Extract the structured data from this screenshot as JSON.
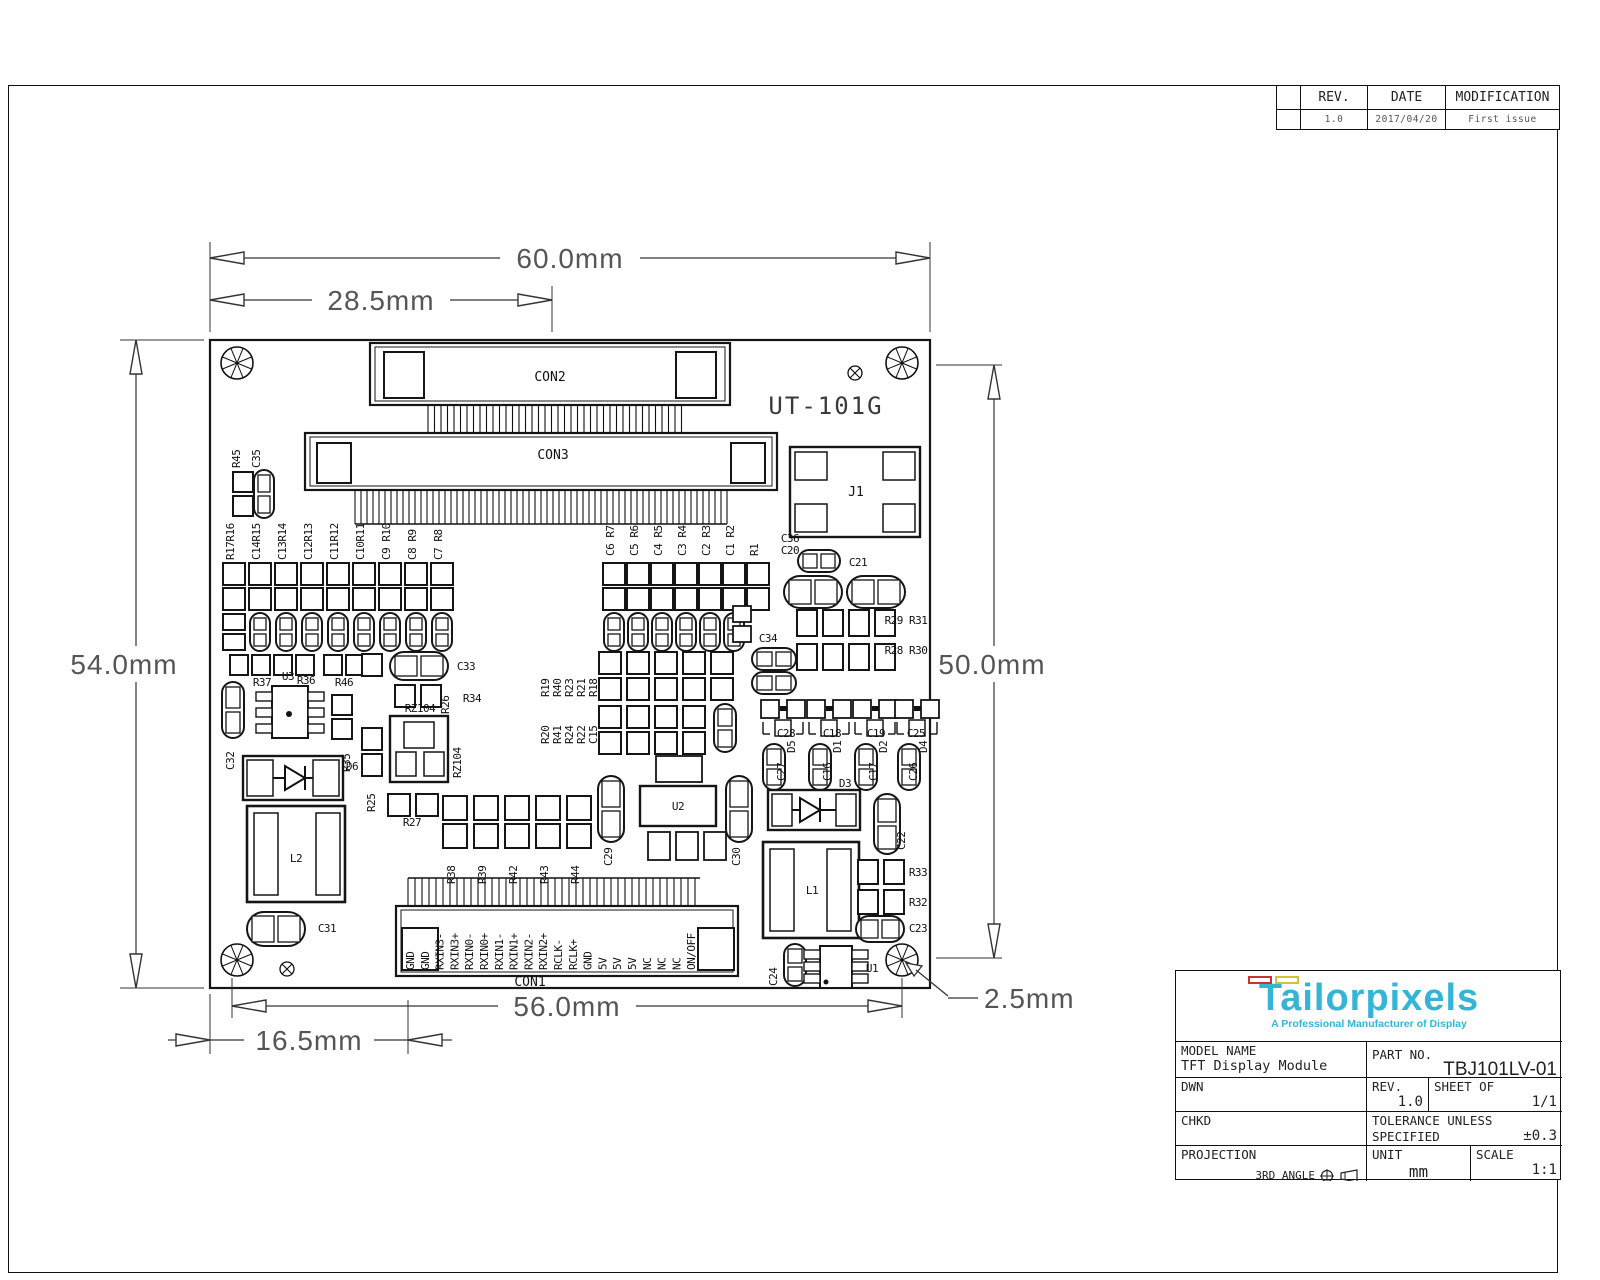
{
  "revision_table": {
    "headers": [
      "REV.",
      "DATE",
      "MODIFICATION"
    ],
    "row": {
      "rev": "1.0",
      "date": "2017/04/20",
      "modification": "First issue"
    }
  },
  "title_block": {
    "logo_text": "Tailorpixels",
    "logo_tagline": "A Professional Manufacturer of Display",
    "colors": {
      "accent_cyan": "#35b5d6",
      "flag_red": "#cc3333",
      "flag_yellow": "#cfc23a"
    },
    "fields": {
      "model_name_label": "MODEL NAME",
      "model_name": "TFT Display Module",
      "part_no_label": "PART NO.",
      "part_no": "TBJ101LV-01",
      "dwn_label": "DWN",
      "rev_label": "REV.",
      "rev": "1.0",
      "sheet_label": "SHEET OF",
      "sheet": "1/1",
      "chkd_label": "CHKD",
      "tolerance_label_line1": "TOLERANCE UNLESS",
      "tolerance_label_line2": "SPECIFIED",
      "tolerance": "±0.3",
      "projection_label": "PROJECTION",
      "projection": "3RD ANGLE",
      "unit_label": "UNIT",
      "unit": "mm",
      "scale_label": "SCALE",
      "scale": "1:1"
    }
  },
  "drawing": {
    "board_title": "UT-101G",
    "dimensions": {
      "width_overall": "60.0mm",
      "width_con2": "28.5mm",
      "height_left": "54.0mm",
      "height_right": "50.0mm",
      "width_bottom": "56.0mm",
      "offset_con1": "16.5mm",
      "hole_inset": "2.5mm"
    },
    "connector_labels": {
      "con1": "CON1",
      "con2": "CON2",
      "con3": "CON3",
      "j1": "J1"
    },
    "con1_pins": [
      "GND",
      "GND",
      "RXIN3-",
      "RXIN3+",
      "RXIN0-",
      "RXIN0+",
      "RXIN1-",
      "RXIN1+",
      "RXIN2-",
      "RXIN2+",
      "RCLK-",
      "RCLK+",
      "GND",
      "5V",
      "5V",
      "5V",
      "NC",
      "NC",
      "NC",
      "ON/OFF"
    ],
    "component_labels": [
      {
        "t": "R45",
        "x": 240,
        "y": 468,
        "v": 1
      },
      {
        "t": "C35",
        "x": 260,
        "y": 468,
        "v": 1
      },
      {
        "t": "R17R16",
        "x": 234,
        "y": 560,
        "v": 1
      },
      {
        "t": "C14R15",
        "x": 260,
        "y": 560,
        "v": 1
      },
      {
        "t": "C13R14",
        "x": 286,
        "y": 560,
        "v": 1
      },
      {
        "t": "C12R13",
        "x": 312,
        "y": 560,
        "v": 1
      },
      {
        "t": "C11R12",
        "x": 338,
        "y": 560,
        "v": 1
      },
      {
        "t": "C10R11",
        "x": 364,
        "y": 560,
        "v": 1
      },
      {
        "t": "C9 R10",
        "x": 390,
        "y": 560,
        "v": 1
      },
      {
        "t": "C8 R9",
        "x": 416,
        "y": 560,
        "v": 1
      },
      {
        "t": "C7 R8",
        "x": 442,
        "y": 560,
        "v": 1
      },
      {
        "t": "C6 R7",
        "x": 614,
        "y": 556,
        "v": 1
      },
      {
        "t": "C5 R6",
        "x": 638,
        "y": 556,
        "v": 1
      },
      {
        "t": "C4 R5",
        "x": 662,
        "y": 556,
        "v": 1
      },
      {
        "t": "C3 R4",
        "x": 686,
        "y": 556,
        "v": 1
      },
      {
        "t": "C2 R3",
        "x": 710,
        "y": 556,
        "v": 1
      },
      {
        "t": "C1 R2",
        "x": 734,
        "y": 556,
        "v": 1
      },
      {
        "t": "R1",
        "x": 758,
        "y": 556,
        "v": 1
      },
      {
        "t": "C32",
        "x": 234,
        "y": 770,
        "v": 1
      },
      {
        "t": "R35",
        "x": 350,
        "y": 772,
        "v": 1
      },
      {
        "t": "R26",
        "x": 449,
        "y": 714,
        "v": 1
      },
      {
        "t": "RZ104",
        "x": 461,
        "y": 778,
        "v": 1
      },
      {
        "t": "R25",
        "x": 375,
        "y": 812,
        "v": 1
      },
      {
        "t": "R38",
        "x": 455,
        "y": 884,
        "v": 1
      },
      {
        "t": "R39",
        "x": 486,
        "y": 884,
        "v": 1
      },
      {
        "t": "R42",
        "x": 517,
        "y": 884,
        "v": 1
      },
      {
        "t": "R43",
        "x": 548,
        "y": 884,
        "v": 1
      },
      {
        "t": "R44",
        "x": 579,
        "y": 884,
        "v": 1
      },
      {
        "t": "R19",
        "x": 549,
        "y": 697,
        "v": 1
      },
      {
        "t": "R40",
        "x": 561,
        "y": 697,
        "v": 1
      },
      {
        "t": "R23",
        "x": 573,
        "y": 697,
        "v": 1
      },
      {
        "t": "R21",
        "x": 585,
        "y": 697,
        "v": 1
      },
      {
        "t": "R18",
        "x": 597,
        "y": 697,
        "v": 1
      },
      {
        "t": "R20",
        "x": 549,
        "y": 744,
        "v": 1
      },
      {
        "t": "R41",
        "x": 561,
        "y": 744,
        "v": 1
      },
      {
        "t": "R24",
        "x": 573,
        "y": 744,
        "v": 1
      },
      {
        "t": "R22",
        "x": 585,
        "y": 744,
        "v": 1
      },
      {
        "t": "C15",
        "x": 597,
        "y": 744,
        "v": 1
      },
      {
        "t": "C29",
        "x": 612,
        "y": 866,
        "v": 1
      },
      {
        "t": "C30",
        "x": 740,
        "y": 866,
        "v": 1
      },
      {
        "t": "D5",
        "x": 795,
        "y": 753,
        "v": 1
      },
      {
        "t": "C27",
        "x": 785,
        "y": 781,
        "v": 1
      },
      {
        "t": "D1",
        "x": 841,
        "y": 753,
        "v": 1
      },
      {
        "t": "C16",
        "x": 831,
        "y": 781,
        "v": 1
      },
      {
        "t": "D2",
        "x": 887,
        "y": 753,
        "v": 1
      },
      {
        "t": "C17",
        "x": 877,
        "y": 781,
        "v": 1
      },
      {
        "t": "D4",
        "x": 927,
        "y": 753,
        "v": 1
      },
      {
        "t": "C26",
        "x": 917,
        "y": 781,
        "v": 1
      },
      {
        "t": "C22",
        "x": 905,
        "y": 850,
        "v": 1
      },
      {
        "t": "C24",
        "x": 777,
        "y": 986,
        "v": 1
      },
      {
        "t": "R37",
        "x": 262,
        "y": 686,
        "v": 0
      },
      {
        "t": "R36",
        "x": 306,
        "y": 684,
        "v": 0
      },
      {
        "t": "R46",
        "x": 344,
        "y": 686,
        "v": 0
      },
      {
        "t": "U3",
        "x": 288,
        "y": 680,
        "v": 0
      },
      {
        "t": "C33",
        "x": 466,
        "y": 670,
        "v": 0
      },
      {
        "t": "R34",
        "x": 472,
        "y": 702,
        "v": 0
      },
      {
        "t": "RZ104",
        "x": 420,
        "y": 712,
        "v": 0
      },
      {
        "t": "D6",
        "x": 352,
        "y": 770,
        "v": 0
      },
      {
        "t": "R27",
        "x": 412,
        "y": 826,
        "v": 0
      },
      {
        "t": "L2",
        "x": 296,
        "y": 862,
        "v": 0
      },
      {
        "t": "C31",
        "x": 327,
        "y": 932,
        "v": 0
      },
      {
        "t": "U2",
        "x": 678,
        "y": 810,
        "v": 0
      },
      {
        "t": "C36",
        "x": 790,
        "y": 542,
        "v": 0
      },
      {
        "t": "C20",
        "x": 790,
        "y": 554,
        "v": 0
      },
      {
        "t": "C21",
        "x": 858,
        "y": 566,
        "v": 0
      },
      {
        "t": "R29 R31",
        "x": 906,
        "y": 624,
        "v": 0
      },
      {
        "t": "R28 R30",
        "x": 906,
        "y": 654,
        "v": 0
      },
      {
        "t": "C34",
        "x": 768,
        "y": 642,
        "v": 0
      },
      {
        "t": "C28",
        "x": 786,
        "y": 737,
        "v": 0
      },
      {
        "t": "C18",
        "x": 832,
        "y": 737,
        "v": 0
      },
      {
        "t": "C19",
        "x": 876,
        "y": 737,
        "v": 0
      },
      {
        "t": "C25",
        "x": 916,
        "y": 737,
        "v": 0
      },
      {
        "t": "D3",
        "x": 845,
        "y": 787,
        "v": 0
      },
      {
        "t": "R33",
        "x": 918,
        "y": 876,
        "v": 0
      },
      {
        "t": "R32",
        "x": 918,
        "y": 906,
        "v": 0
      },
      {
        "t": "C23",
        "x": 918,
        "y": 932,
        "v": 0
      },
      {
        "t": "L1",
        "x": 812,
        "y": 894,
        "v": 0
      },
      {
        "t": "U1",
        "x": 872,
        "y": 972,
        "v": 0
      }
    ]
  }
}
